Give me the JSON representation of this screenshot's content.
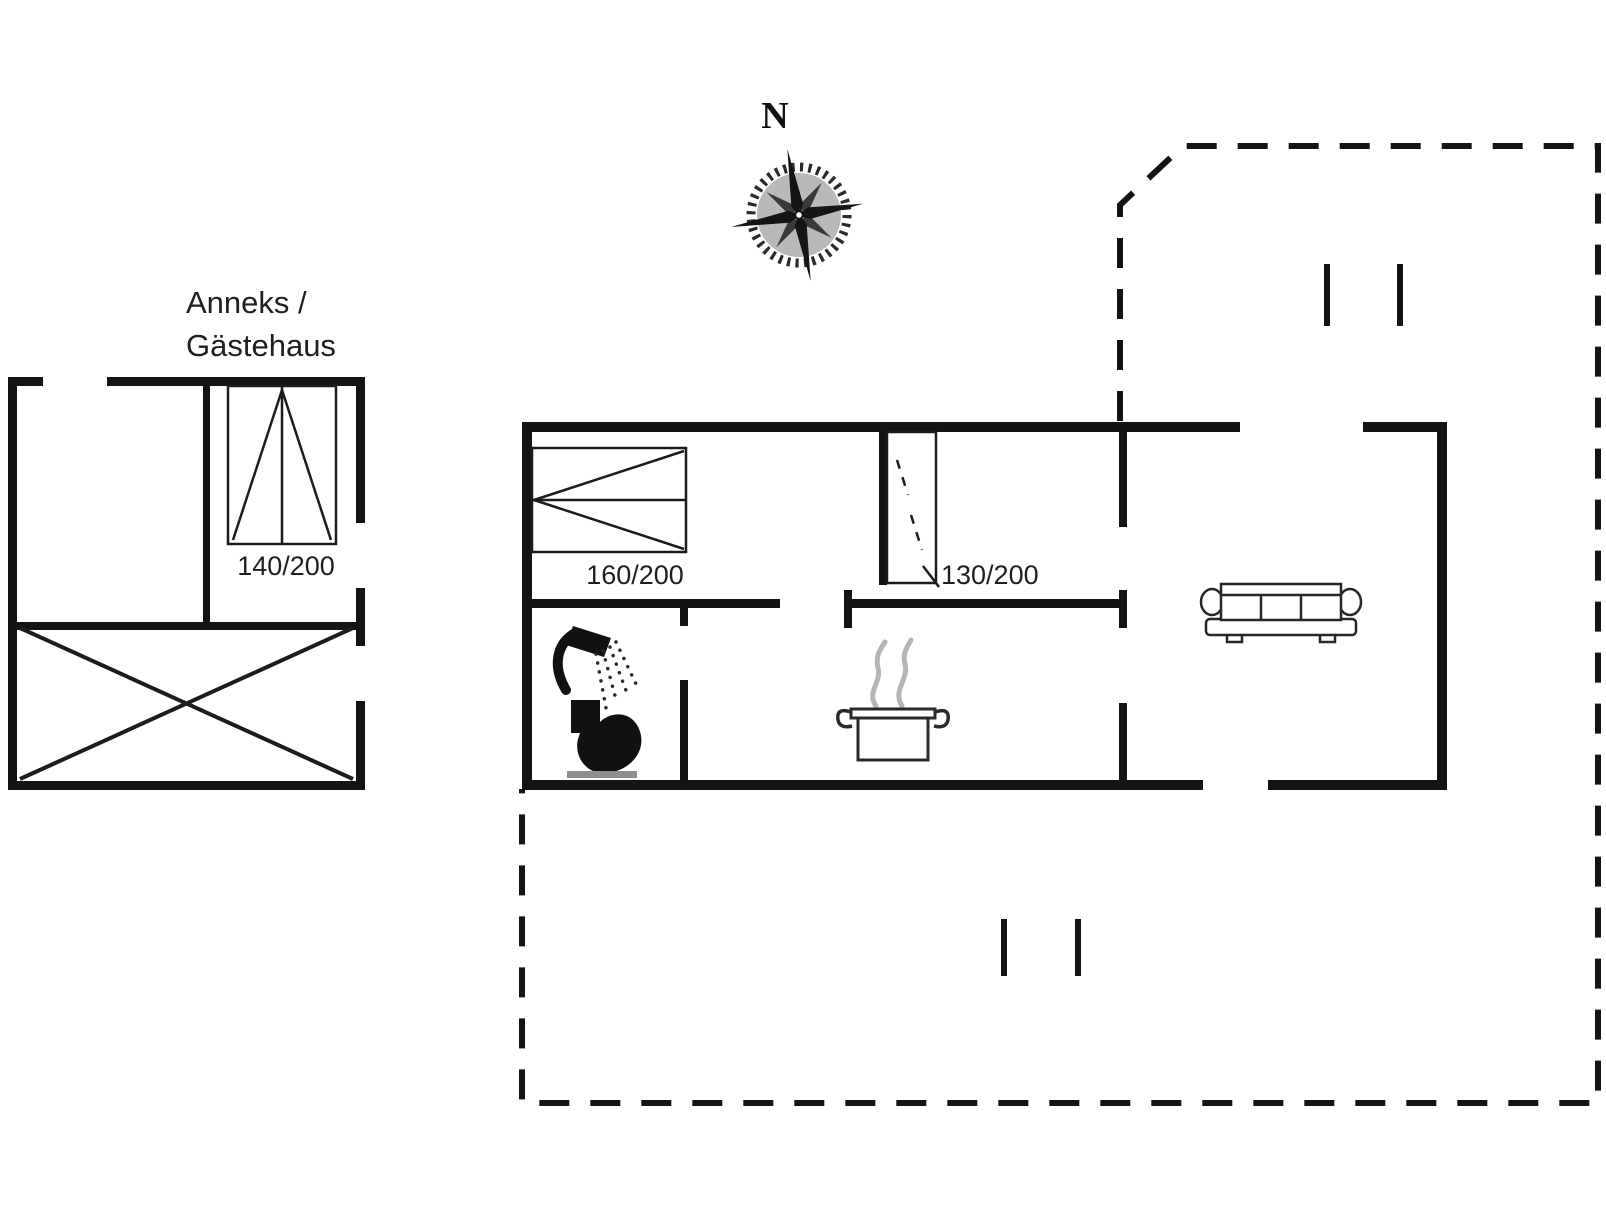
{
  "page": {
    "width": 1606,
    "height": 1205,
    "background": "#ffffff",
    "type": "holiday-house floor plan"
  },
  "labels": {
    "north": "N",
    "annex_line1": "Anneks /",
    "annex_line2": "Gästehaus",
    "annex_bed_size": "140/200",
    "bedroom1_bed_size": "160/200",
    "bedroom2_bed_size": "130/200"
  },
  "colors": {
    "wall": "#141414",
    "thin_line": "#1c1c1c",
    "steam": "#b5b5b5",
    "toilet_base": "#8f8f8f",
    "background": "#ffffff"
  },
  "icons": [
    {
      "name": "compass-rose-icon",
      "meaning": "north orientation"
    },
    {
      "name": "double-bed-140-icon",
      "meaning": "double bed 140/200 in annex"
    },
    {
      "name": "double-bed-160-icon",
      "meaning": "double bed 160/200 in bedroom 1"
    },
    {
      "name": "single-bed-130-icon",
      "meaning": "bed 130/200 in bedroom 2"
    },
    {
      "name": "shower-icon",
      "meaning": "shower in bathroom"
    },
    {
      "name": "toilet-icon",
      "meaning": "WC in bathroom"
    },
    {
      "name": "cooking-pot-icon",
      "meaning": "kitchen / stove"
    },
    {
      "name": "sofa-icon",
      "meaning": "living room sofa"
    },
    {
      "name": "cross-marked-area",
      "meaning": "covered terrace / storage of annex"
    },
    {
      "name": "dashed-boundary",
      "meaning": "open terrace outline"
    }
  ]
}
